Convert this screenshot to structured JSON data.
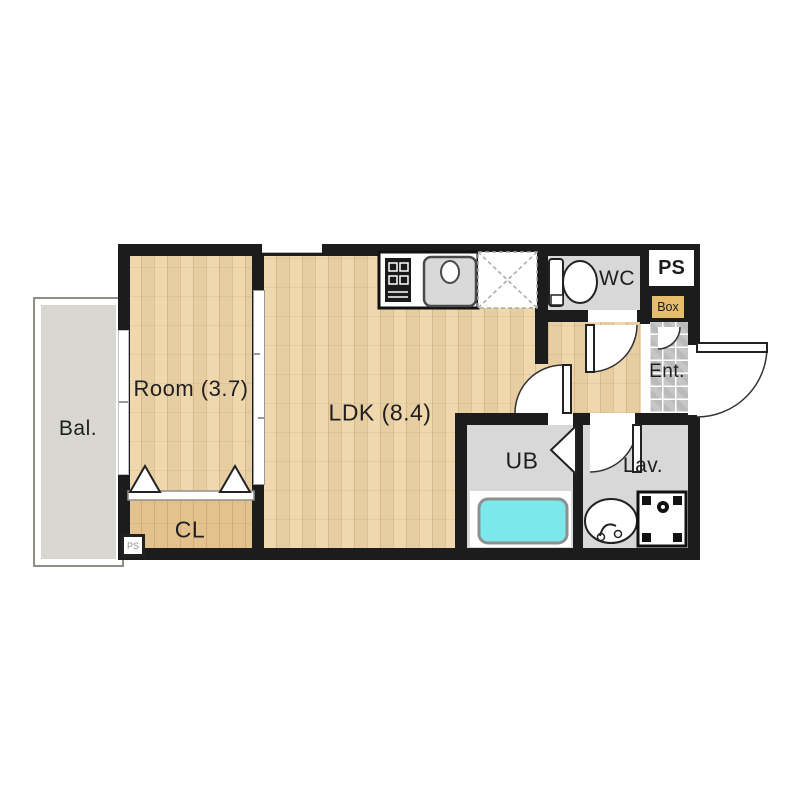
{
  "floorplan": {
    "rooms": {
      "balcony": {
        "label": "Bal."
      },
      "bedroom": {
        "label": "Room (3.7)"
      },
      "ldk": {
        "label": "LDK (8.4)"
      },
      "closet": {
        "label": "CL"
      },
      "unit_bath": {
        "label": "UB"
      },
      "lavatory": {
        "label": "Lav."
      },
      "wc": {
        "label": "WC"
      },
      "pipe_space": {
        "label": "PS"
      },
      "pipe_space_small": {
        "label": "PS"
      },
      "meter_box": {
        "label": "Box"
      },
      "entrance": {
        "label": "Ent."
      }
    },
    "icons": [
      "toilet-icon",
      "kitchen-sink-icon",
      "gas-stove-icon",
      "refrigerator-space-icon",
      "bathtub-icon",
      "washing-machine-pan-icon",
      "lavatory-sink-icon",
      "door-swing-icon",
      "folding-door-icon",
      "sliding-door-icon",
      "window-icon"
    ],
    "colors": {
      "wall": "#1c1c1c",
      "wood_floor": "#efd5a8",
      "closet_floor": "#e3c28e",
      "balcony_floor": "#d8d7d0",
      "wet_area_floor": "#d8d8d8",
      "entrance_tile": "#c6c6c6",
      "bathtub": "#7be9ec",
      "meter_box_fill": "#e5bd6d"
    }
  }
}
